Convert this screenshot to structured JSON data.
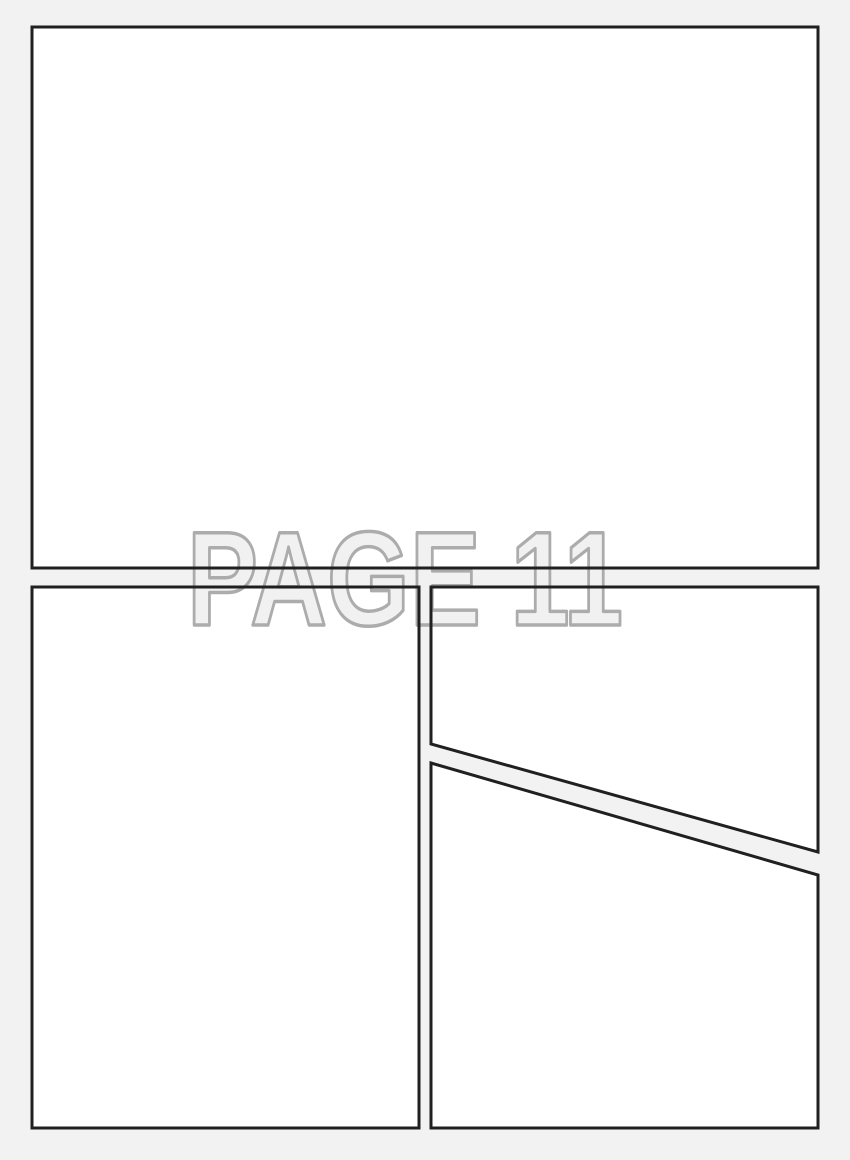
{
  "page": {
    "background_color": "#f2f2f2",
    "watermark": {
      "text": "PAGE 11",
      "fill_color": "#f1f1f1",
      "stroke_color": "#a8a8a8"
    }
  },
  "panels": {
    "fill_color": "#ffffff",
    "border_color": "#202020",
    "items": [
      {
        "id": "panel-1",
        "description": "large top panel",
        "points": "32,27 818,27 818,568 32,568"
      },
      {
        "id": "panel-2",
        "description": "tall bottom-left panel",
        "points": "32,587 419,587 419,1128 32,1128"
      },
      {
        "id": "panel-3",
        "description": "top-right panel with diagonal bottom edge",
        "points": "431,587 818,587 818,852 431,744"
      },
      {
        "id": "panel-4",
        "description": "bottom-right panel with diagonal top edge",
        "points": "431,763 818,875 818,1128 431,1128"
      }
    ]
  }
}
